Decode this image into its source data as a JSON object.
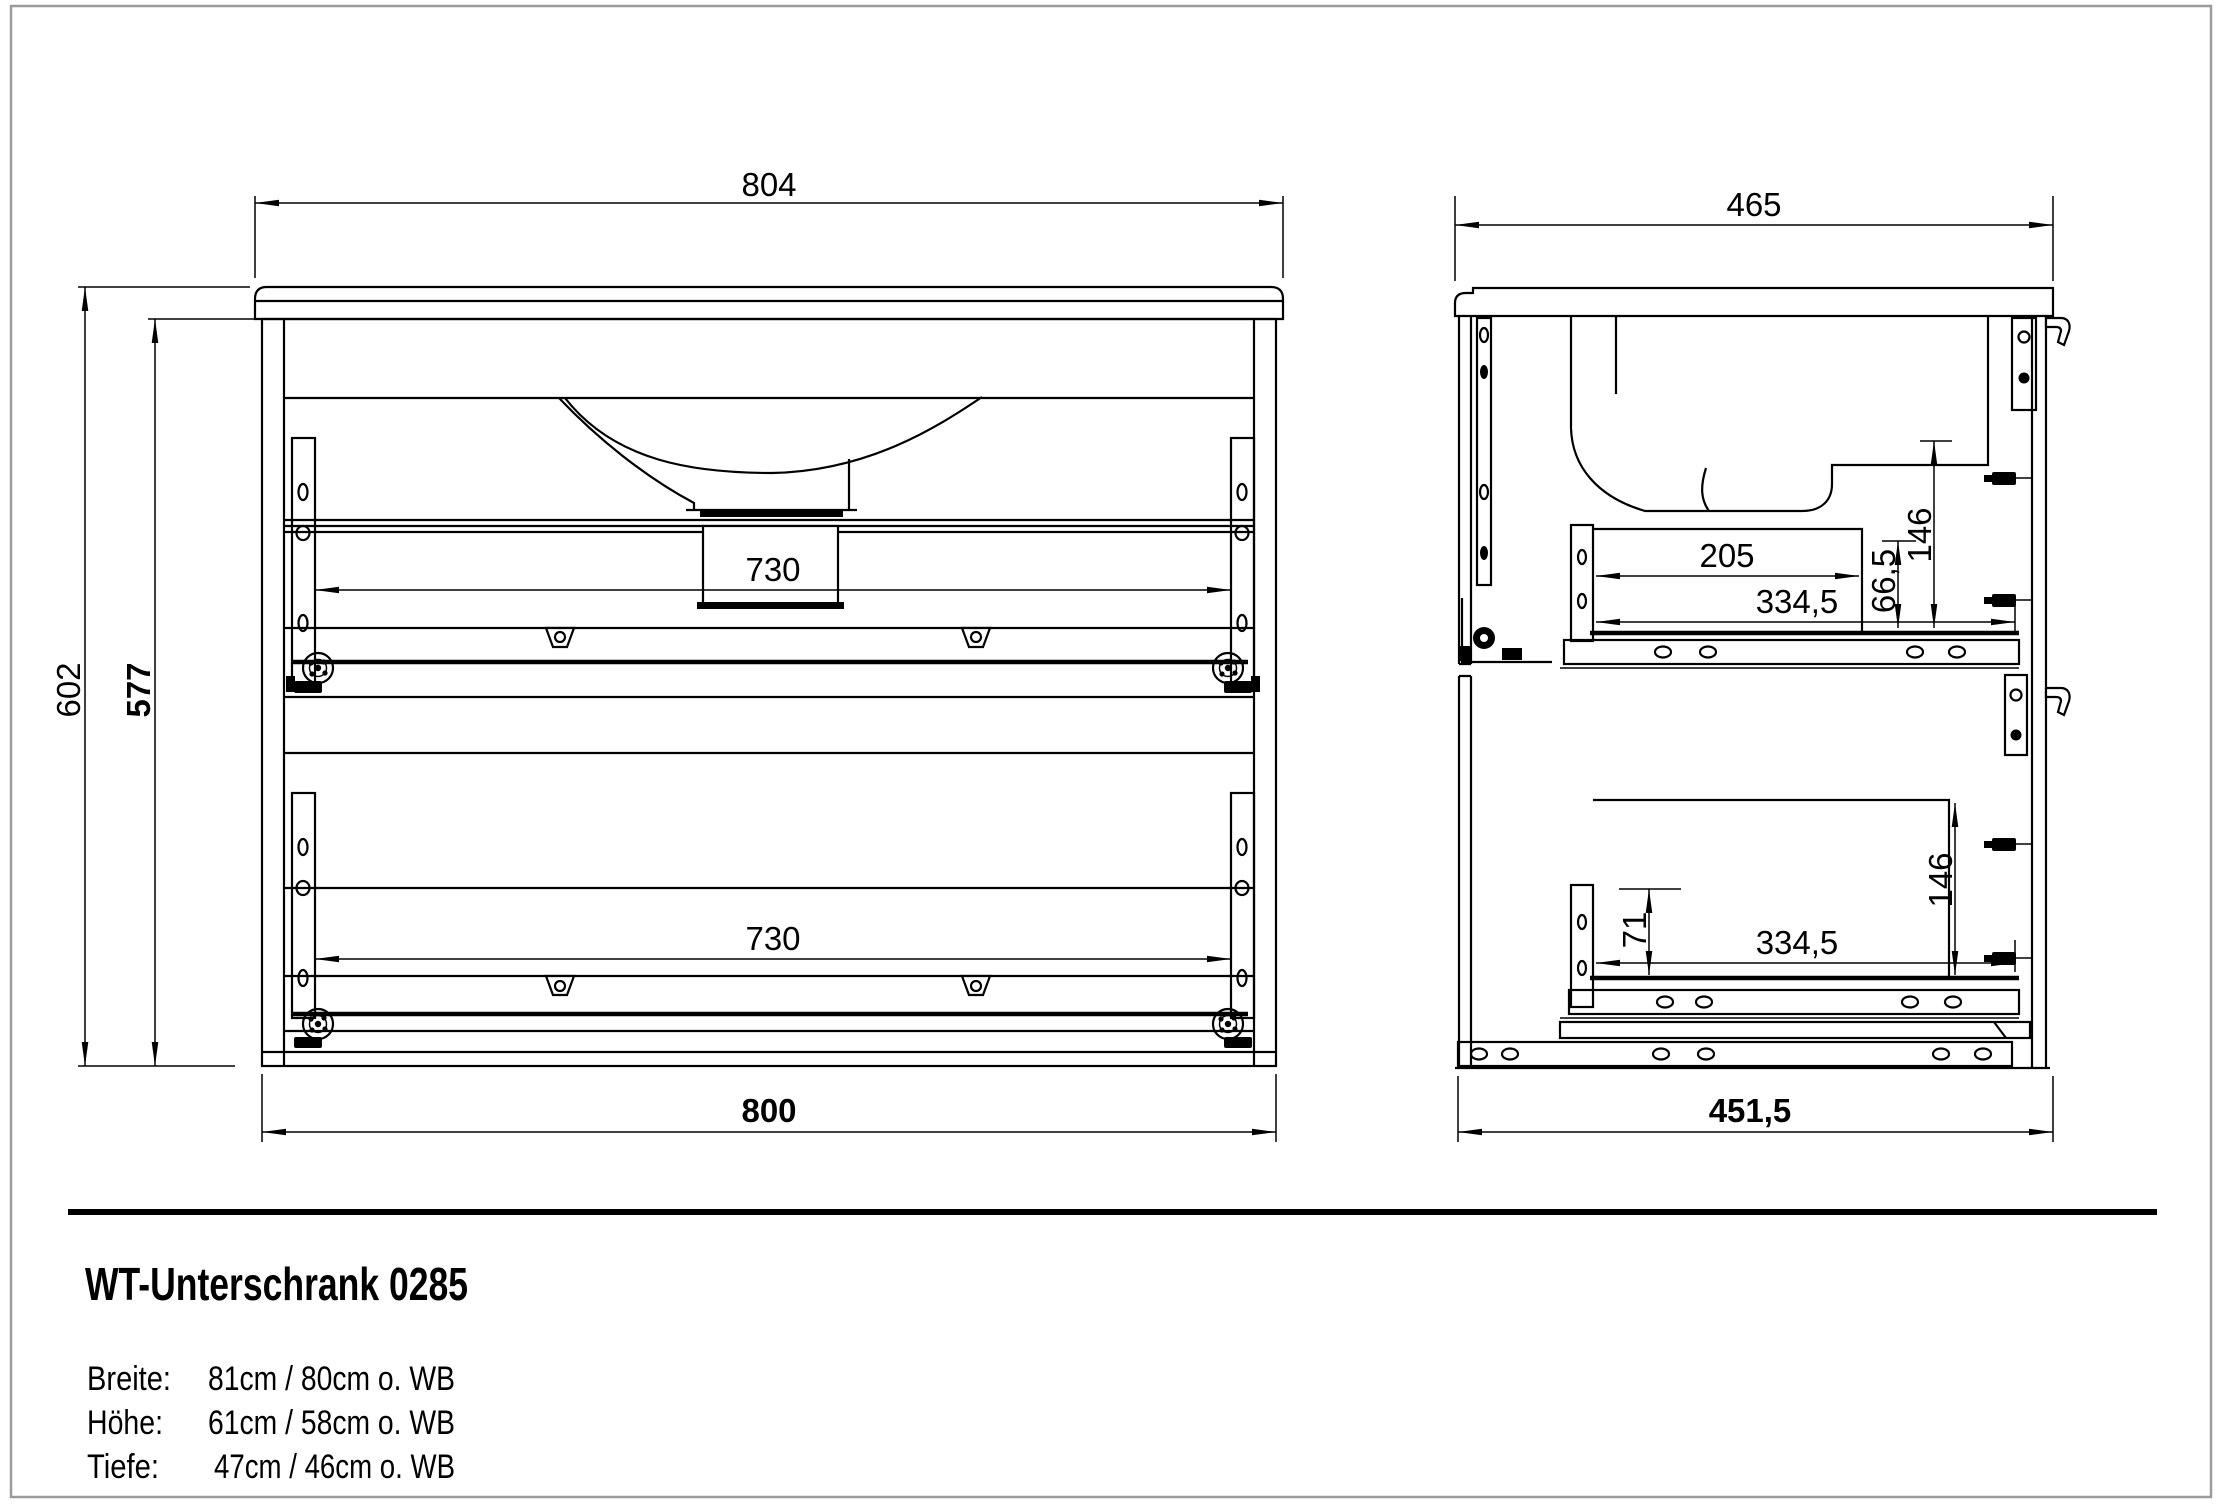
{
  "drawing": {
    "front_view": {
      "dim_top": "804",
      "dim_height_outer": "602",
      "dim_height_inner": "577",
      "dim_drawer_top": "730",
      "dim_drawer_bottom": "730",
      "dim_bottom": "800"
    },
    "side_view": {
      "dim_top": "465",
      "dim_drawer_inner": "205",
      "dim_slide_top": "334,5",
      "dim_front_gap_top": "66,5",
      "dim_clear_top": "146",
      "dim_front_gap_bottom": "71",
      "dim_slide_bottom": "334,5",
      "dim_clear_bottom": "146",
      "dim_bottom": "451,5"
    }
  },
  "title_block": {
    "title": "WT-Unterschrank 0285",
    "specs": [
      {
        "label": "Breite:",
        "value": "81cm / 80cm o. WB"
      },
      {
        "label": "Höhe:",
        "value": "61cm / 58cm o. WB"
      },
      {
        "label": "Tiefe:",
        "value": "47cm / 46cm o. WB"
      }
    ]
  }
}
